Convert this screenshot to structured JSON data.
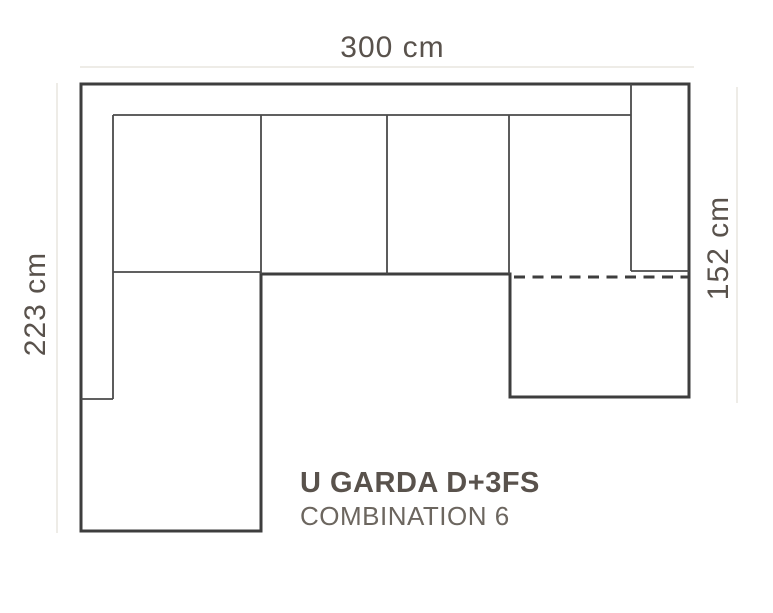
{
  "diagram": {
    "type": "sofa-combination-floorplan",
    "product": {
      "title": "U GARDA D+3FS",
      "subtitle": "COMBINATION 6"
    },
    "dimensions": {
      "top_width": "300 cm",
      "left_depth": "223 cm",
      "right_depth": "152 cm"
    },
    "colors": {
      "background": "#ffffff",
      "outline": "#3e3e3e",
      "inner_lines": "#4a4a4a",
      "dimension_lines": "#e9e6df",
      "label_text": "#59524c",
      "subtitle_text": "#6c665f"
    }
  }
}
